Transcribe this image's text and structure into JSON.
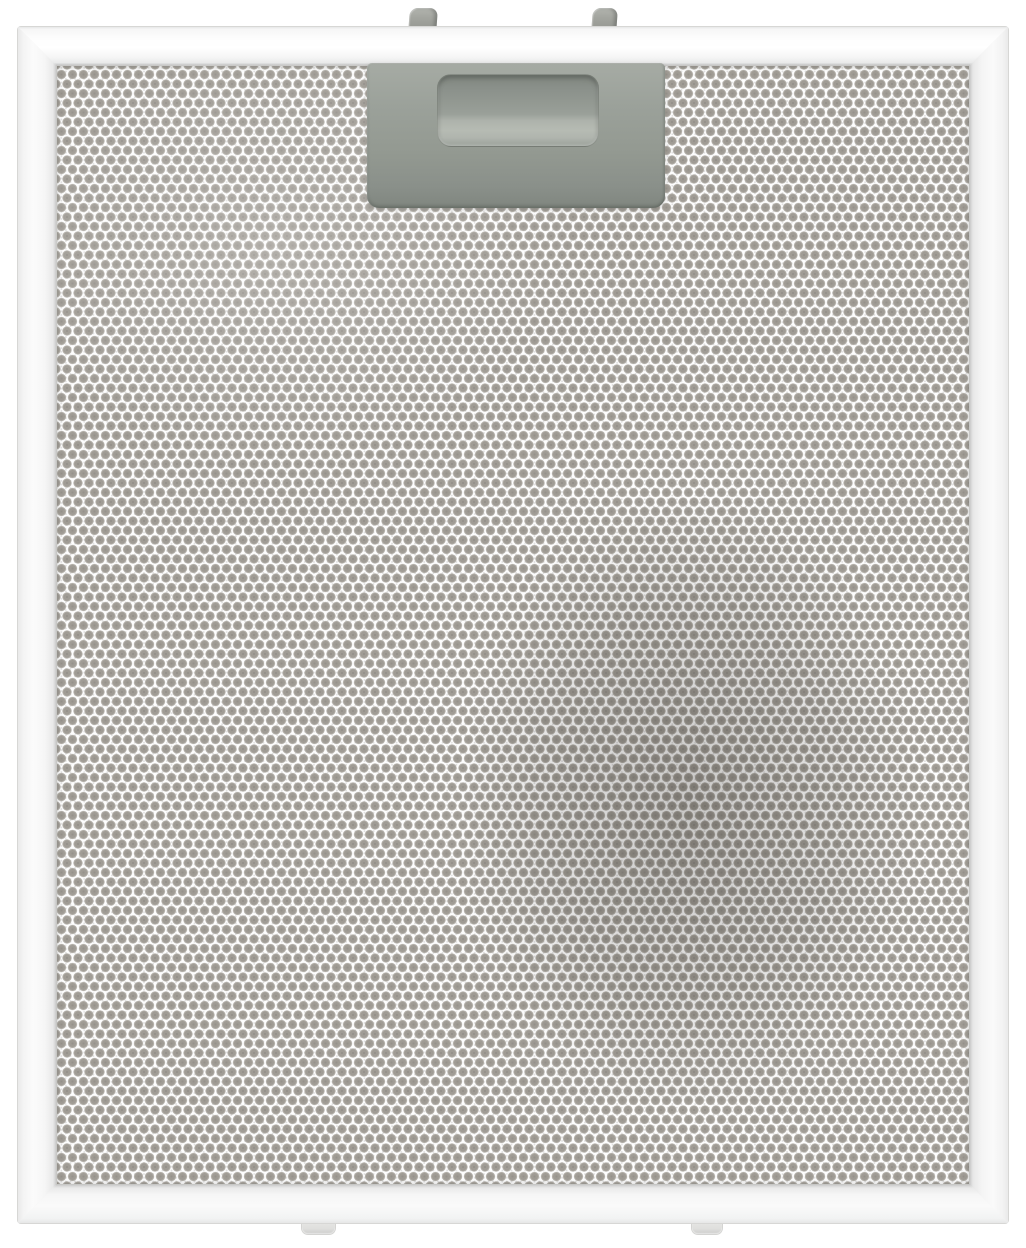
{
  "image": {
    "type": "product-photo",
    "description": "Silver rectangular metal mesh grease filter for a cooker hood with a grey plastic release latch at the top centre, two grey clips on the top edge and two light clips on the bottom edge, shown front-on against a white background",
    "background_color": "#ffffff"
  },
  "filter": {
    "frame": {
      "label": "aluminium-frame",
      "face_color": "#f7f7f7",
      "edge_line_color": "#c9c9c7"
    },
    "mesh": {
      "label": "expanded-aluminium-mesh",
      "dot_color": "#9c9891",
      "gap_color": "#ffffff",
      "shading_color": "#5f5c58"
    },
    "latch": {
      "label": "release-latch",
      "body_color": "#99a098",
      "recess_highlight_color": "#b4b9b1",
      "shadow_color": "#7f857f"
    },
    "top_clips": {
      "count": 2,
      "color": "#9b9d97"
    },
    "bottom_clips": {
      "count": 2,
      "color": "#dcdcda"
    }
  }
}
